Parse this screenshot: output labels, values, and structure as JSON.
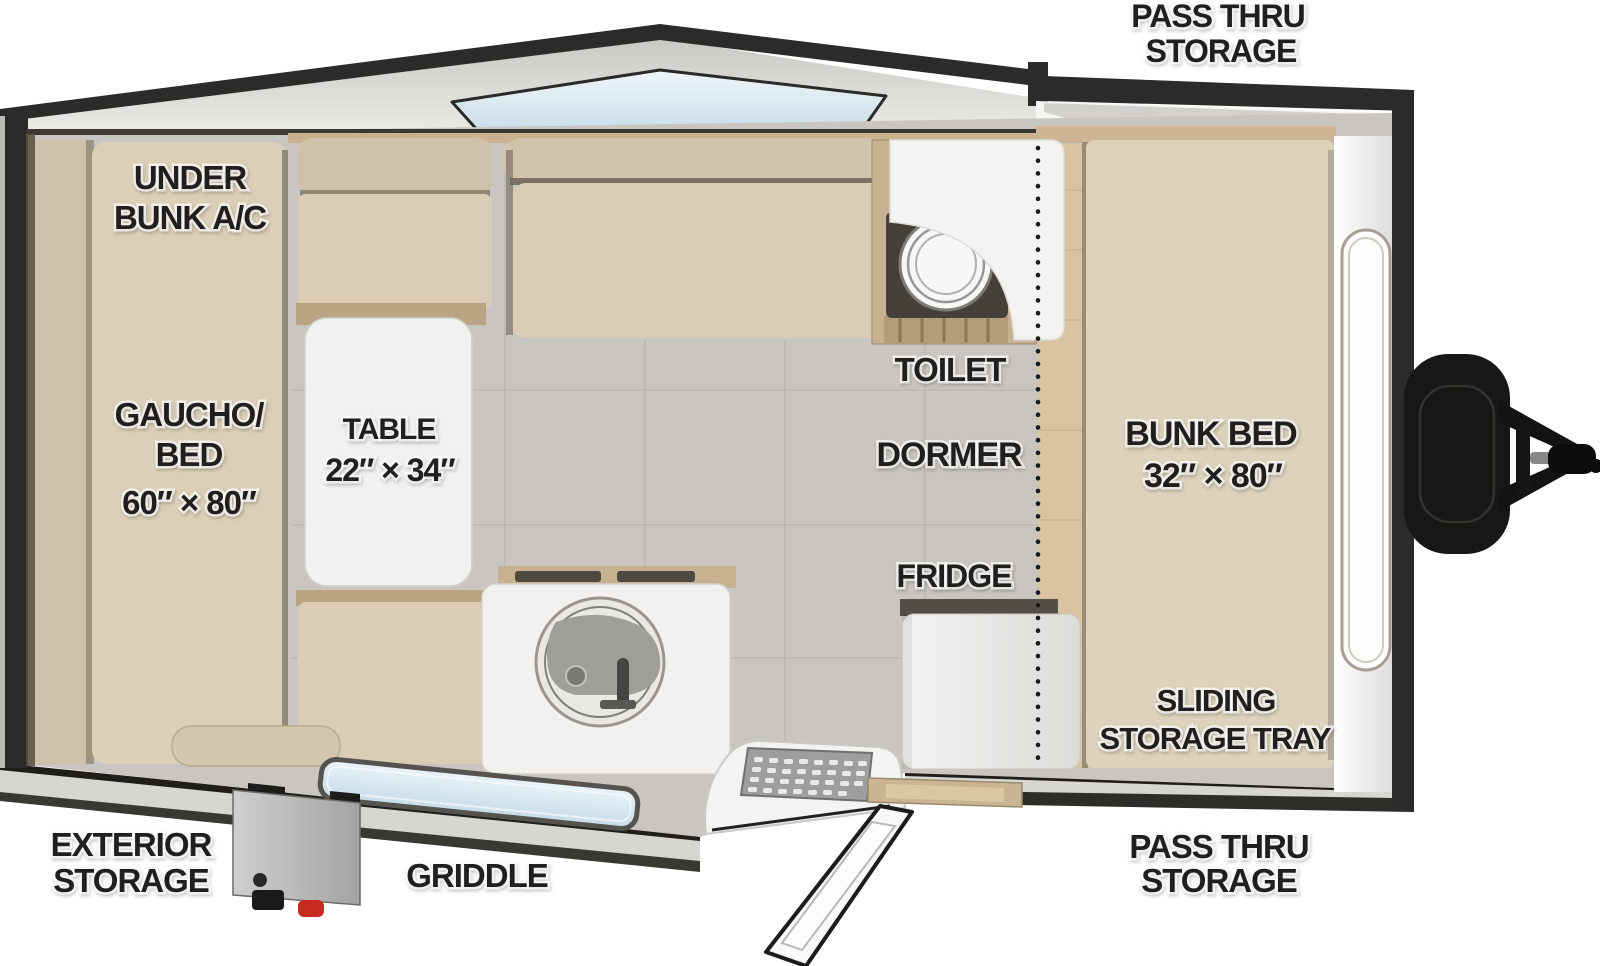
{
  "title": "A-frame camper travel trailer floor plan",
  "labels": {
    "pass_thru_top": {
      "line1": "PASS THRU",
      "line2": "STORAGE"
    },
    "under_bunk_ac": {
      "line1": "UNDER",
      "line2": "BUNK A/C"
    },
    "gaucho_bed": {
      "line1": "GAUCHO/",
      "line2": "BED",
      "line3": "60″ × 80″"
    },
    "table": {
      "line1": "TABLE",
      "line2": "22″ × 34″"
    },
    "toilet": {
      "text": "TOILET"
    },
    "dormer": {
      "text": "DORMER"
    },
    "fridge": {
      "text": "FRIDGE"
    },
    "bunk_bed": {
      "line1": "BUNK BED",
      "line2": "32″ × 80″"
    },
    "sliding_storage_tray": {
      "line1": "SLIDING",
      "line2": "STORAGE TRAY"
    },
    "exterior_storage": {
      "line1": "EXTERIOR",
      "line2": "STORAGE"
    },
    "griddle": {
      "text": "GRIDDLE"
    },
    "pass_thru_bottom": {
      "line1": "PASS THRU",
      "line2": "STORAGE"
    }
  },
  "colors": {
    "shell_dark": "#2c2b29",
    "roof_gray": "#dddcd8",
    "cushion_beige": "#d6c8b0",
    "cushion_light": "#dccfb8",
    "wood_tan": "#c6b190",
    "floor_tile": "#c9c6c1",
    "glass_blue": "#d8e7f0",
    "white_fixture": "#f2f1ef",
    "label_text": "#201f1d",
    "knob_red": "#c8291f"
  }
}
